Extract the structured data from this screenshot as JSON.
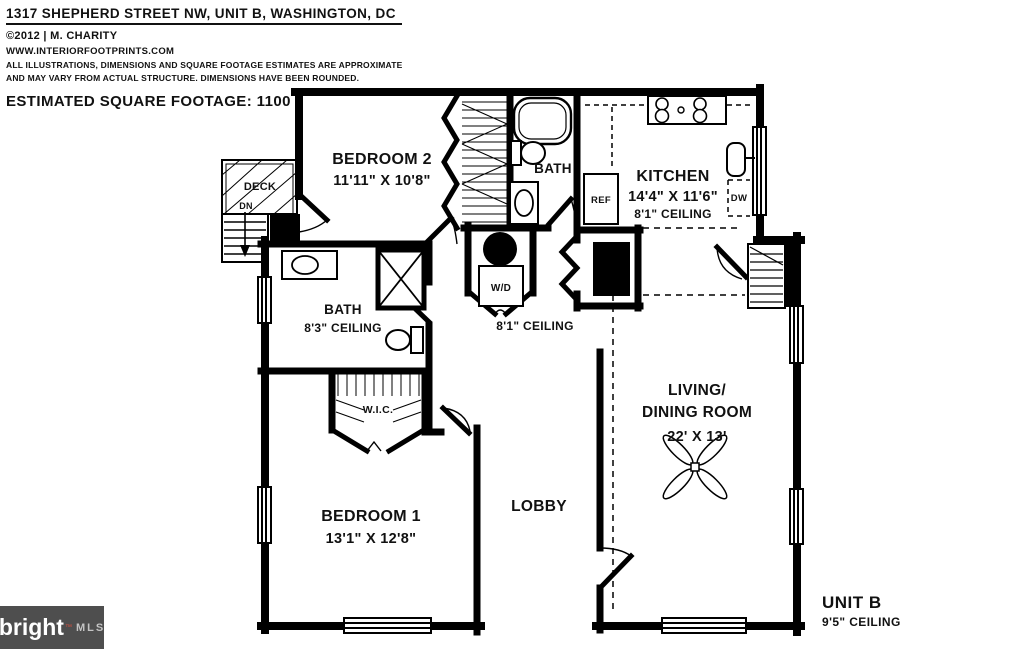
{
  "header": {
    "title": "1317 SHEPHERD STREET NW, UNIT B, WASHINGTON, DC",
    "copyright": "©2012 | M. CHARITY",
    "website": "WWW.INTERIORFOOTPRINTS.COM",
    "disclaimer1": "ALL ILLUSTRATIONS, DIMENSIONS AND SQUARE FOOTAGE ESTIMATES ARE APPROXIMATE",
    "disclaimer2": "AND MAY VARY FROM ACTUAL STRUCTURE. DIMENSIONS HAVE BEEN ROUNDED.",
    "square_footage": "ESTIMATED SQUARE FOOTAGE: 1100"
  },
  "plan": {
    "rooms": {
      "deck": {
        "label": "DECK",
        "direction": "DN"
      },
      "bedroom2": {
        "label": "BEDROOM 2",
        "dims": "11'11\" X 10'8\""
      },
      "bath_upper": {
        "label": "BATH"
      },
      "kitchen": {
        "label": "KITCHEN",
        "dims": "14'4\" X 11'6\"",
        "ceiling": "8'1\" CEILING"
      },
      "bath_main": {
        "label": "BATH",
        "ceiling": "8'3\" CEILING"
      },
      "hall": {
        "ceiling": "8'1\" CEILING"
      },
      "laundry": {
        "label": "W/D"
      },
      "closet": {
        "label": "W.I.C."
      },
      "bedroom1": {
        "label": "BEDROOM 1",
        "dims": "13'1\" X 12'8\""
      },
      "lobby": {
        "label": "LOBBY"
      },
      "living": {
        "label_line1": "LIVING/",
        "label_line2": "DINING ROOM",
        "dims": "22' X 13'"
      }
    },
    "appliances": {
      "refrigerator": "REF",
      "dishwasher": "DW"
    }
  },
  "unit": {
    "label": "UNIT B",
    "ceiling": "9'5\" CEILING"
  },
  "logo": {
    "brand": "bright",
    "trademark": "™",
    "suffix": "MLS",
    "background": "#4e4e4e",
    "accent": "#d9503f"
  }
}
